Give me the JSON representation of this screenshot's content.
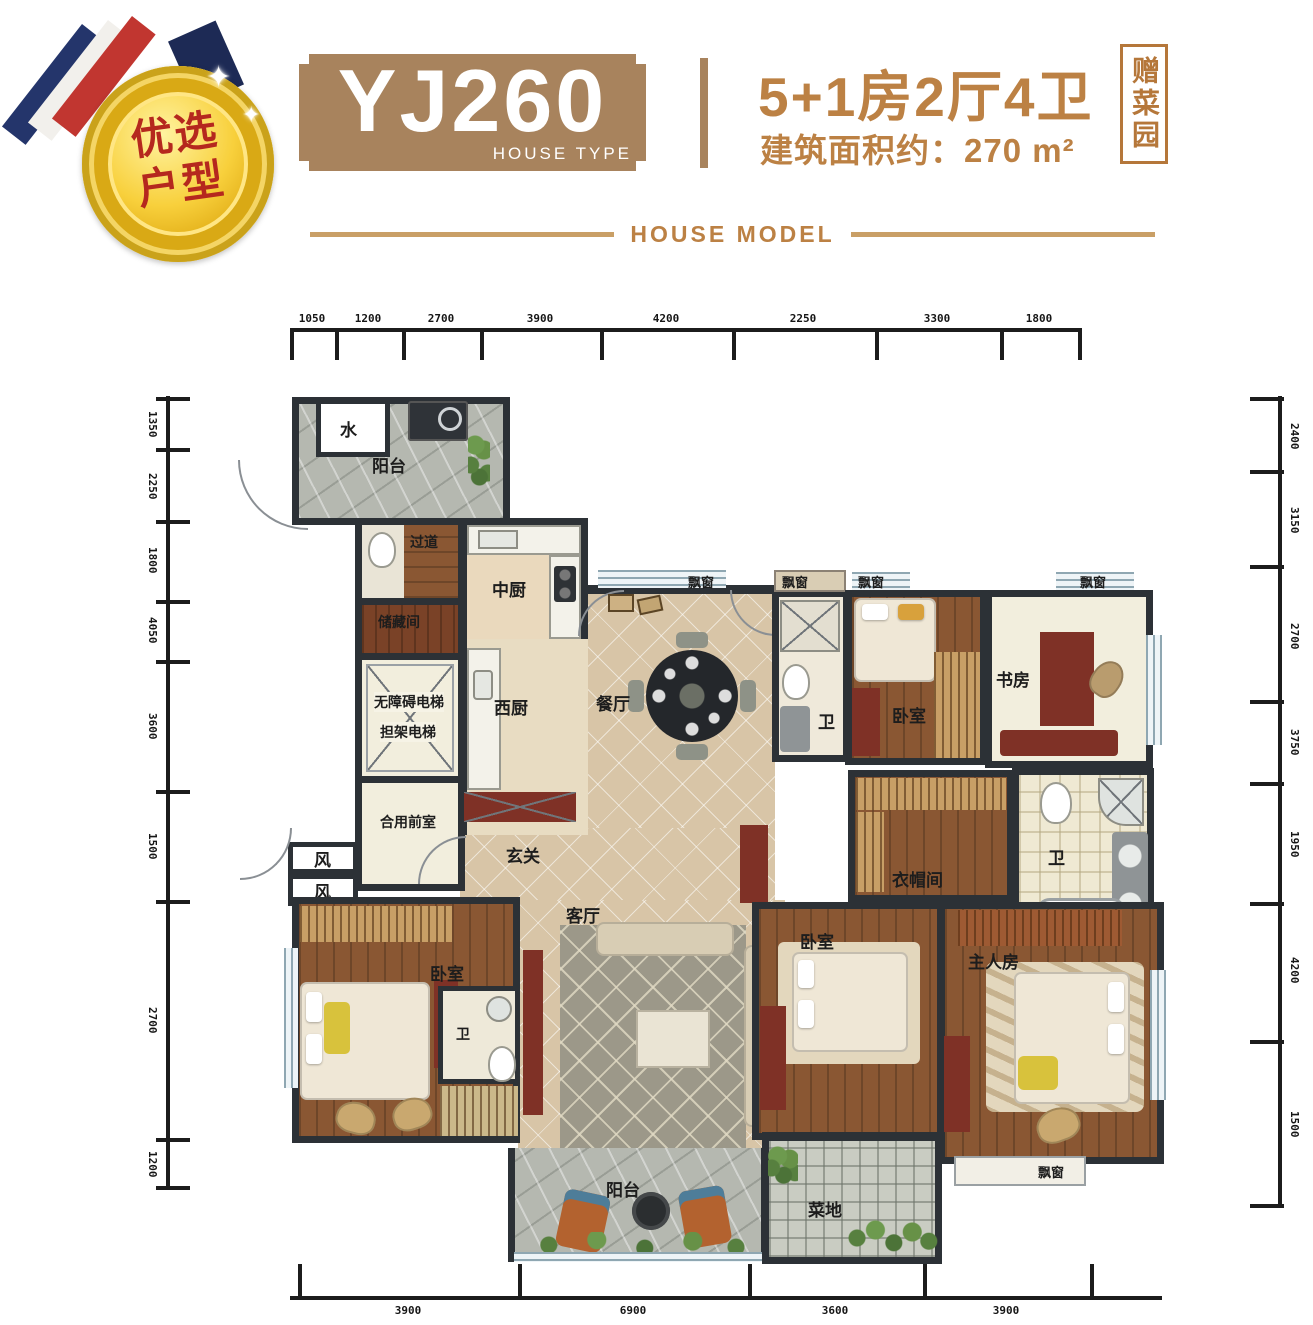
{
  "medal": {
    "line1": "优选",
    "line2": "户型"
  },
  "header": {
    "model": "YJ260",
    "model_sub": "HOUSE TYPE",
    "spec": "5+1房2厅4卫",
    "area": "建筑面积约：270 m²",
    "seal": "赠菜园",
    "divider": "HOUSE MODEL"
  },
  "colors": {
    "plaque": "#a8835d",
    "accent_text": "#bc8144",
    "divider_line": "#c99f66",
    "medal_text": "#b5281e",
    "wall": "#2c3136"
  },
  "plan": {
    "labels": {
      "water": "水",
      "balcony_top": "阳台",
      "corridor": "过道",
      "storage": "储藏间",
      "kitchen_cn": "中厨",
      "kitchen_w": "西厨",
      "elevator1": "无障碍电梯",
      "elevator2": "担架电梯",
      "lobby": "合用前室",
      "wind": "风",
      "dining": "餐厅",
      "foyer": "玄关",
      "living": "客厅",
      "bay": "飘窗",
      "bath": "卫",
      "bedroom": "卧室",
      "study": "书房",
      "cloak": "衣帽间",
      "master": "主人房",
      "garden": "菜地",
      "balcony_bottom": "阳台"
    },
    "dims": {
      "top": [
        "1050",
        "1200",
        "2700",
        "3900",
        "4200",
        "2250",
        "3300",
        "1800"
      ],
      "bottom": [
        "3900",
        "6900",
        "3600",
        "3900"
      ],
      "left": [
        "1350",
        "2250",
        "1800",
        "4050",
        "3600",
        "1500",
        "2700",
        "1200"
      ],
      "right": [
        "2400",
        "3150",
        "2700",
        "3750",
        "1950",
        "4200",
        "1500"
      ]
    }
  }
}
